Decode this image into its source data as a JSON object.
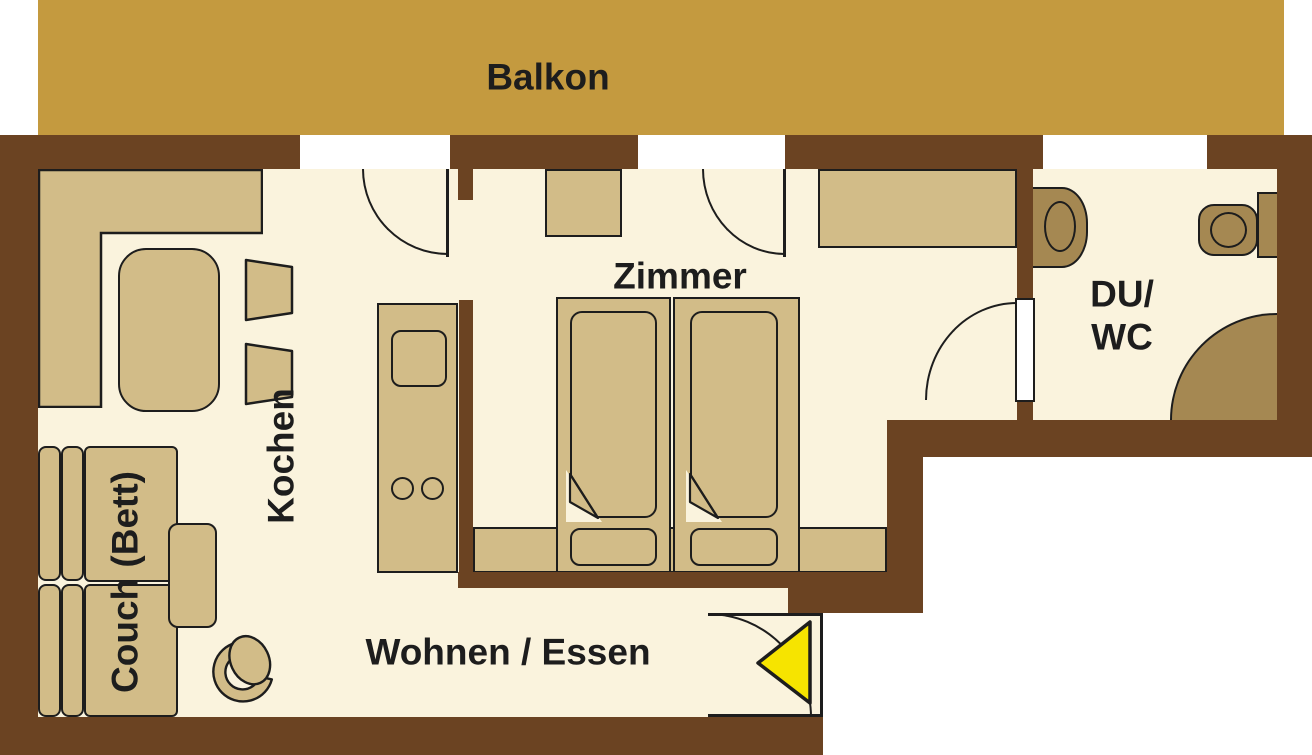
{
  "floorplan": {
    "labels": {
      "balcony": "Balkon",
      "bedroom": "Zimmer",
      "kitchen": "Kochen",
      "couch": "Couch (Bett)",
      "living_dining": "Wohnen / Essen",
      "bath_line1": "DU/",
      "bath_line2": "WC"
    },
    "palette": {
      "wall_brown": "#6b4322",
      "balcony_gold": "#c49a3f",
      "floor_cream": "#faf3dd",
      "furniture_tan": "#d2bc88",
      "fixture_tan": "#a58852",
      "outline_black": "#1d1d1d",
      "entrance_arrow_yellow": "#f6e400",
      "background_white": "#ffffff"
    }
  }
}
